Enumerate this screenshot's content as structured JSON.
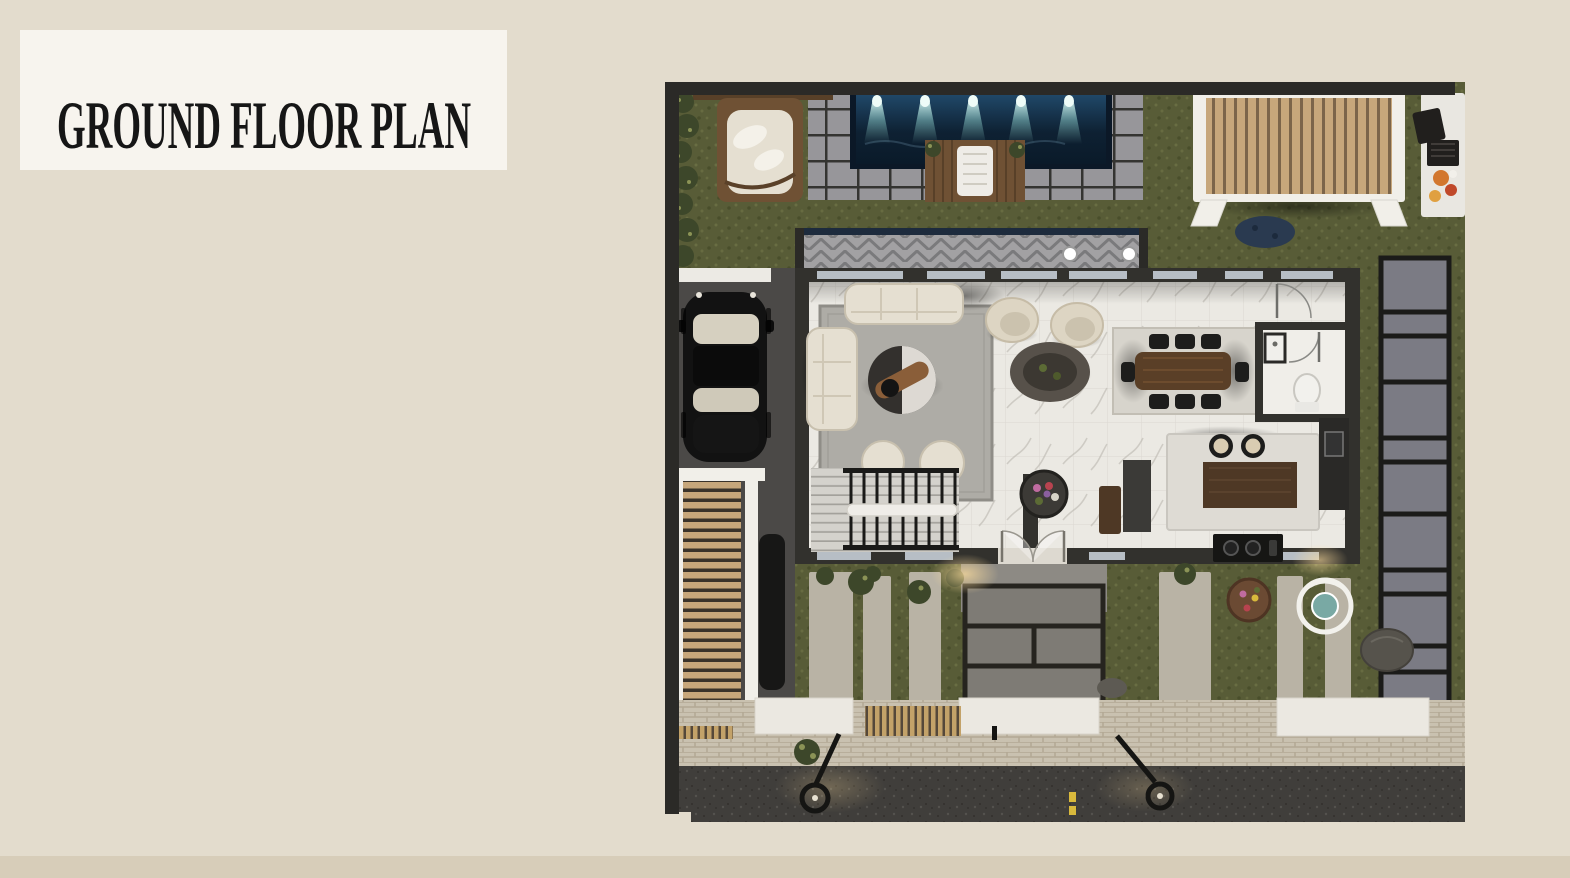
{
  "page": {
    "title_label": "GROUND FLOOR PLAN"
  },
  "plan": {
    "name": "ground-floor-plan-render",
    "features": [
      "swimming-pool",
      "pool-lights",
      "pool-deck",
      "pergola-swing",
      "timber-pergola",
      "bbq-counter",
      "hedge",
      "terrace-deck",
      "driveway",
      "parked-car",
      "carport",
      "second-car",
      "living-room",
      "sofas",
      "coffee-table",
      "armchairs",
      "dining-table",
      "dining-chairs",
      "bathroom",
      "kitchen-island",
      "bar-stools",
      "cooktop",
      "staircase",
      "entry-doors",
      "flower-planter",
      "side-paver-path",
      "front-garden",
      "walkway-strips",
      "hanging-egg-chair",
      "garden-pouf",
      "boulder",
      "sidewalk",
      "wood-grates",
      "street",
      "street-lamps",
      "road-markings"
    ]
  },
  "palette": {
    "bg": "#e3dccd",
    "bg_band": "#d7cdb9",
    "title_box": "#f7f4ee",
    "title_text": "#161616",
    "frame": "#2b2a27",
    "grass": "#585c37",
    "grass_dark": "#434927",
    "grass_light": "#75794b",
    "pool_deep": "#0e2133",
    "pool_mid": "#214a6b",
    "pool_edge": "#0b1827",
    "beam": "#9adfd8",
    "paver": "#97969a",
    "paver_joint": "#343431",
    "deck_wood": "#6f5134",
    "deck_wood_dark": "#584028",
    "towel": "#eeece7",
    "plant": "#3d472a",
    "plant_light": "#8b9356",
    "pergola_white": "#f1efe9",
    "slat": "#c7a77b",
    "slat_gap": "#7c654a",
    "carport_gap": "#3a332a",
    "bbq_counter": "#e9e7e1",
    "grill": "#211f1d",
    "food_a": "#d2772e",
    "food_b": "#c0492a",
    "food_c": "#e0a040",
    "deckstrip": "#a2a1a3",
    "deckstrip_dark": "#707072",
    "navy_edge": "#1d2b3d",
    "drive": "#4b4947",
    "car_black": "#121212",
    "car_glass": "#d6d0c0",
    "wall": "#32312d",
    "glass": "#b7bec5",
    "white_wall": "#eceae4",
    "marble": "#ebe9e3",
    "marble_vein": "#b5b2ab",
    "tile_line": "#dbd8d1",
    "rug": "#aeaca6",
    "rug_border": "#8f8d87",
    "dining_rug": "#d7d4cc",
    "sofa": "#e5dfd1",
    "sofa_line": "#c8c0ae",
    "wood_table": "#5a3f27",
    "chair_black": "#1d1d1c",
    "island": "#dedbd4",
    "cabinet_wood": "#4e3825",
    "counter_dark": "#2a2927",
    "stool_cushion": "#d9ccb2",
    "tread": "#d4d2cc",
    "tread_line": "#a3a19b",
    "rail": "#1a1a18",
    "slab": "#7b7b84",
    "slab_frame": "#1b1b19",
    "walkpaver": "#c9c1b0",
    "walkpaver_joint": "#b2a894",
    "strip_light": "#b9b3a5",
    "sidewalk_white": "#ebe8e1",
    "grate_wood": "#c3a269",
    "grate_dark": "#55483a",
    "road": "#403e3b",
    "road_light": "#54524e",
    "road_dark": "#34322f",
    "lamp": "#151513",
    "yellow": "#d9b93c",
    "glow": "#ffdf9e",
    "egg_white": "#f2f1ec",
    "egg_teal": "#79a9a4",
    "pouf": "#6b4a33",
    "boulder": "#56534c",
    "path_gray": "#8d8a84",
    "panel": "#7e7b75",
    "panel_frame": "#26241f"
  }
}
